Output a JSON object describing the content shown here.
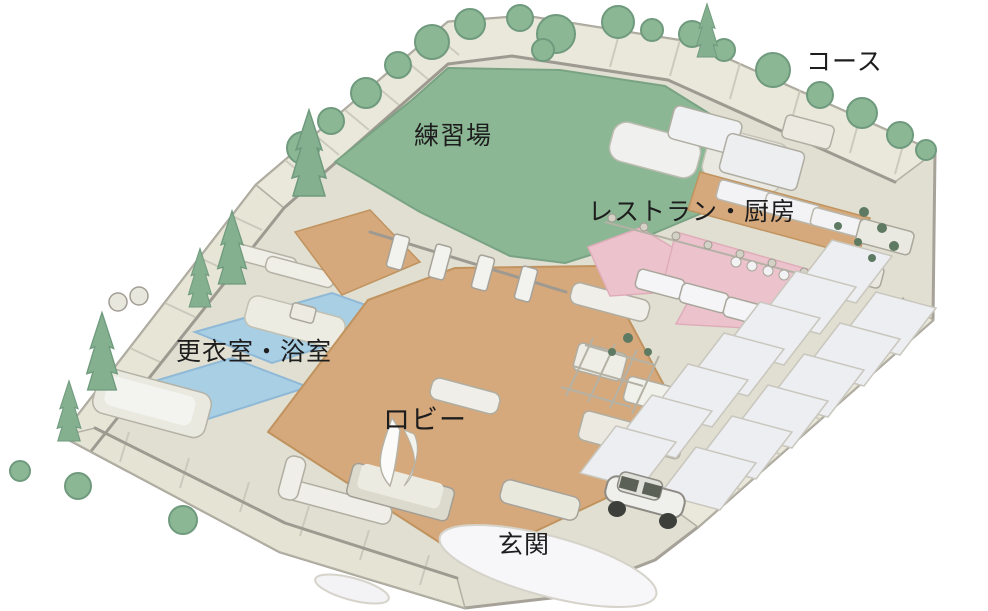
{
  "map": {
    "labels": {
      "course": "コース",
      "practice_range": "練習場",
      "restaurant_kitchen": "レストラン・厨房",
      "locker_bath": "更衣室・浴室",
      "lobby": "ロビー",
      "entrance": "玄関"
    },
    "colors": {
      "background": "#ffffff",
      "ground_beige": "#e0dfd1",
      "walkway_beige": "#e9e8da",
      "wall_gray": "#9e9a91",
      "grass_green": "#8cb795",
      "tree_green": "#85b08f",
      "shrub_dark_green": "#5e7a62",
      "lobby_tan": "#d6a97c",
      "bath_blue": "#a9cfe5",
      "restaurant_pink": "#ecc3cd",
      "room_white": "#f2f2f4",
      "parking_gray": "#edeef2",
      "label_text": "#1d1d1d"
    }
  }
}
